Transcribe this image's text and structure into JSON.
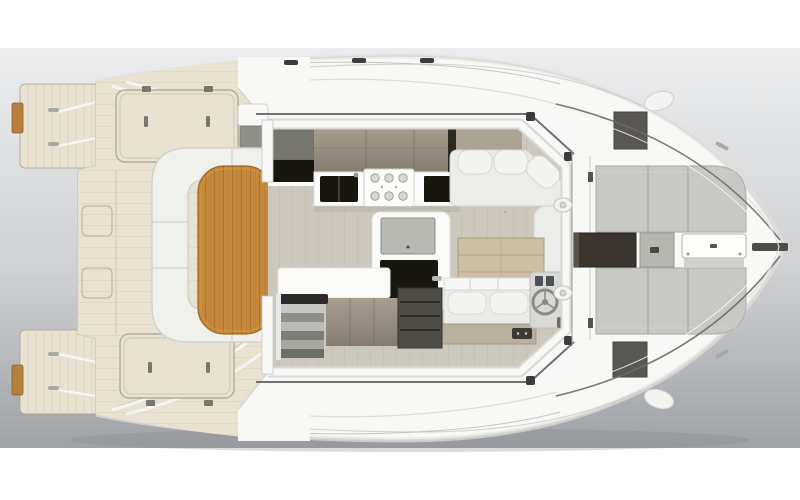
{
  "canvas": {
    "width": 800,
    "height": 500
  },
  "palette": {
    "page_bg": "#ffffff",
    "backdrop_top": "#ecedee",
    "backdrop_mid": "#cfd1d3",
    "backdrop_bottom": "#9fa2a6",
    "boat_shadow": "#84878c",
    "hull_white": "#f8f8f6",
    "hull_edge": "#c7c7c4",
    "hull_inner_shade": "#e3e3e0",
    "deck_cream": "#e9e2d1",
    "deck_cream_line": "#a9a192",
    "hatch_fitting": "#77766f",
    "teak_wood": "#c6883c",
    "teak_grain": "#9e6a1e",
    "swim_step_teak": "#b5803e",
    "swim_step_edge": "#8a5f26",
    "sofa_white": "#f0f0ed",
    "sofa_edge": "#d2d2cc",
    "cushion_gray": "#ececea",
    "pillow_white": "#f3f3f0",
    "floor_greige": "#cdc8be",
    "floor_line": "#bdb7ac",
    "taupe_light": "#a79e8f",
    "taupe_dark": "#857d70",
    "cabinet_gray": "#77776f",
    "cabinet_gray_dark": "#68685f",
    "appliance_black": "#17160f",
    "counter_white": "#fbfbfa",
    "counter_edge": "#e2e2dd",
    "island_panel_gray": "#b9b9b4",
    "wood_table_light": "#cbbfa4",
    "wood_table_line": "#a99c80",
    "pad_gray": "#c8c8c4",
    "pad_seam": "#a9a9a4",
    "pad_edge": "#b2b2ad",
    "dark_square": "#595751",
    "recess_dark": "#3a362f",
    "recess_edge": "#23211c",
    "helm_console": "#d8d8d4",
    "wheel_gray": "#8a8a86",
    "instrument_blue": "#4a5258",
    "stair_rim": "#2b2a27",
    "shelf_dark": "#4f4d47",
    "rail_dark": "#6b6b68",
    "fitting_dark": "#3c3c3a",
    "metal_gray": "#a8a8a4"
  }
}
